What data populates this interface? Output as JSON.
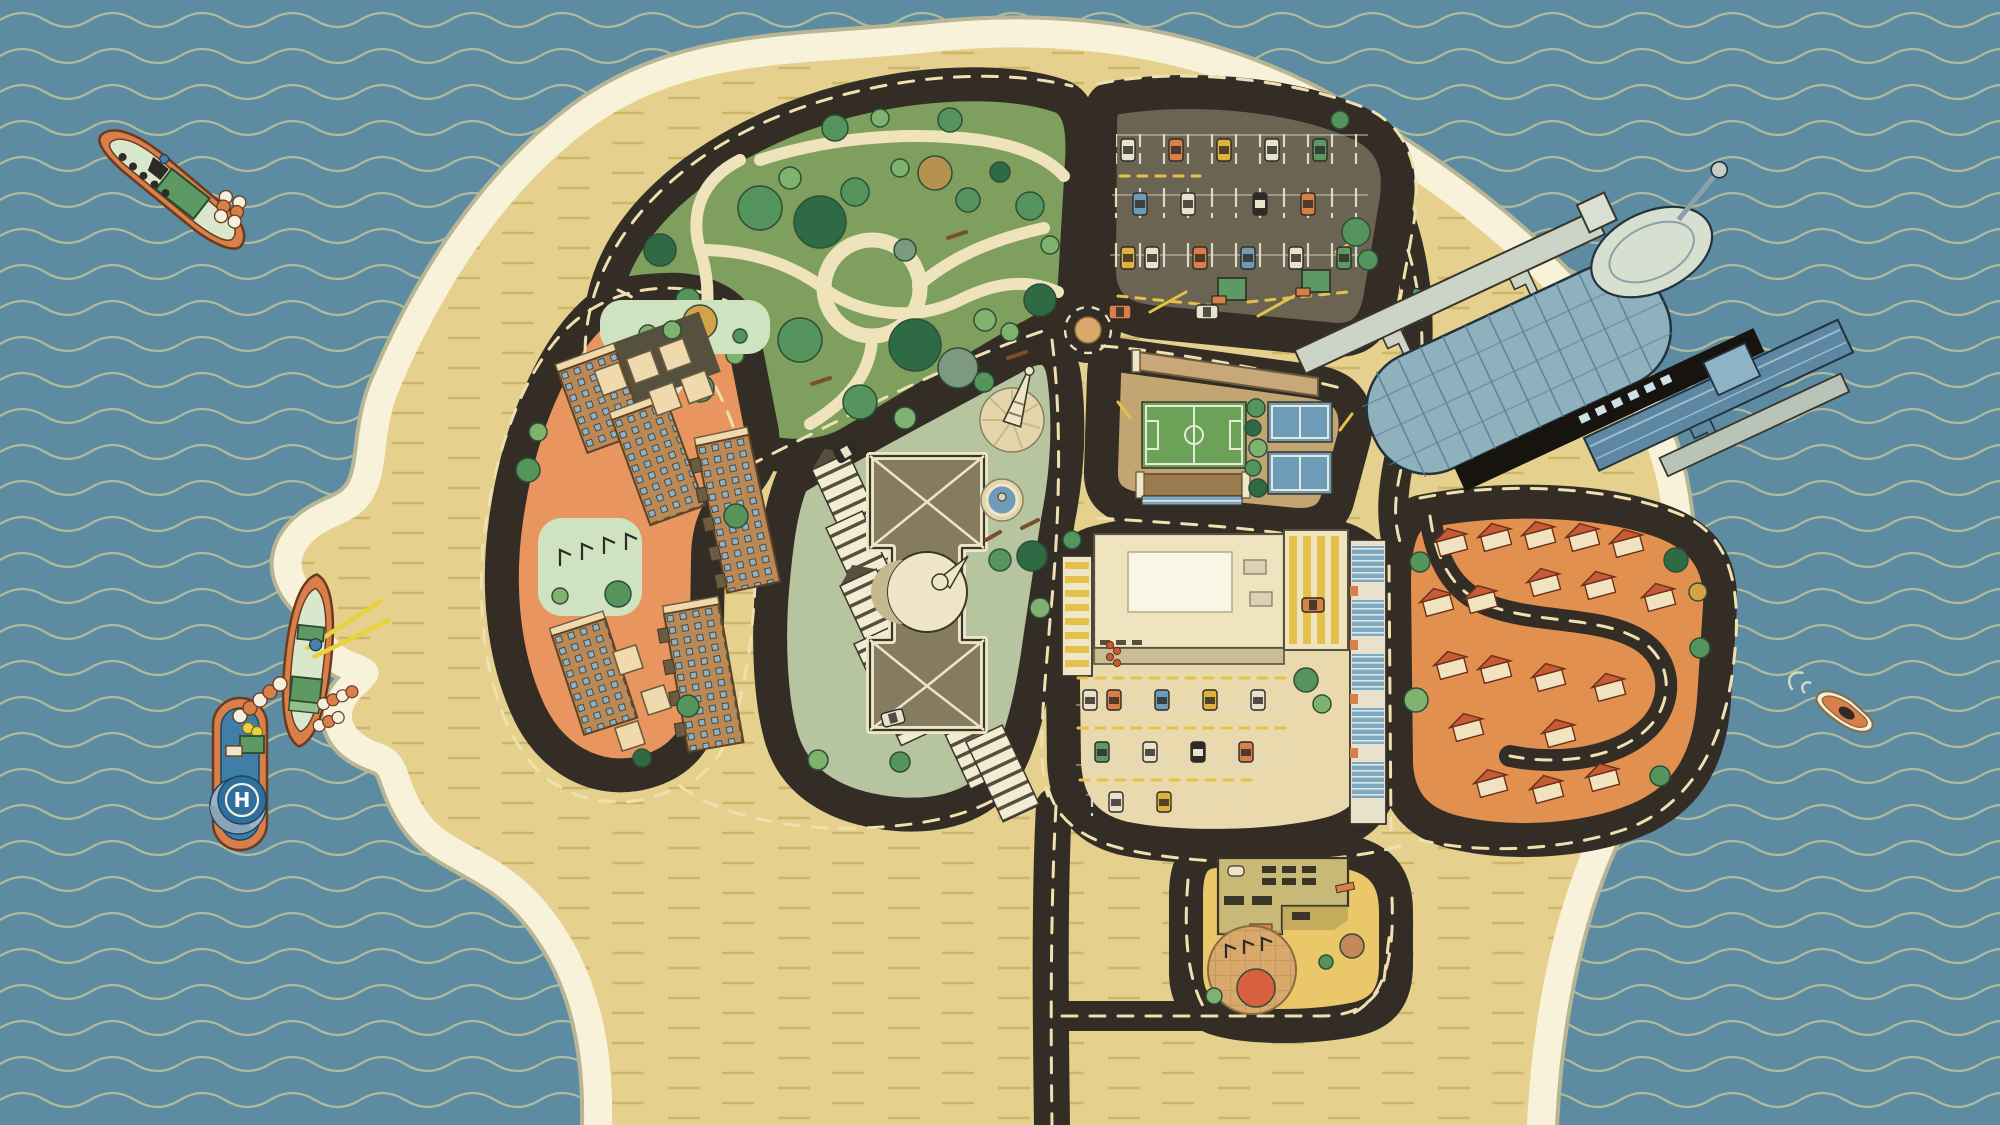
{
  "scene": {
    "description": "Isometric illustration of an island shaped like a human head in profile; the brain is a city map of districts joined by dark ring roads, surrounded by wavy ocean with boats",
    "helipad_letter": "H"
  },
  "palette": {
    "ocean": "#5d8ba1",
    "wave_line": "#aebb9c",
    "shore_rim": "#b8b594",
    "shore_band": "#f8f2da",
    "sand": "#e5d18d",
    "sand_dash": "#cdb56b",
    "road": "#332d26",
    "road_dash": "#efe0b0",
    "lane_dash_yellow": "#e4c14b",
    "parking_line": "#ddd8c4",
    "path_cream": "#efe3bc",
    "pocket_park": "#cfe3c1",
    "roundabout_center": "#d9a96c",
    "fountain_water": "#6f9ab8",
    "dome_cream": "#efe6c8",
    "soccer_green": "#6ba257",
    "tennis_blue": "#6e9cb8",
    "grandstand_brown": "#9b7b4e",
    "sports_hall_tan": "#c8a878",
    "brick": "#b98a58",
    "roof_box_cream": "#efd9ad",
    "slab_white": "#f2ecd4",
    "house_roof": "#c75b36",
    "house_wall": "#f2e3c0",
    "stadium_roof": "#8fb0bd",
    "stadium_rib": "#5f8396",
    "stadium_pod": "#d6dfd0",
    "stadium_beam": "#cbd4c6",
    "stadium_dark": "#17130f",
    "stadium_wing": "#5d87a2",
    "boat_hull_orange": "#d97f4a",
    "boat_deck_mint": "#d9e8cc",
    "boat_cabin_green": "#5d9a63",
    "tug_deck_blue": "#3f7ea6",
    "helipad_blue": "#2e6f9e",
    "rod_yellow": "#e8d23e",
    "tree_dark": "#2e6b45",
    "tree_mid": "#55945d",
    "tree_light": "#7fb26f",
    "tree_pale": "#a3c585",
    "tree_sage": "#7d9a80",
    "tree_tan": "#b5934f",
    "tree_gold": "#d4a247",
    "tree_rust": "#d9603c"
  },
  "districts": [
    {
      "id": "park",
      "name": "City park",
      "color": "#7e9f5e"
    },
    {
      "id": "parking-lot",
      "name": "Parking lot",
      "color": "#6b6452"
    },
    {
      "id": "sports-complex",
      "name": "Sports fields",
      "color": "#c3a571"
    },
    {
      "id": "apartments",
      "name": "Apartment blocks",
      "color": "#e8955f"
    },
    {
      "id": "civic-center",
      "name": "Civic center",
      "color": "#b7c4a0"
    },
    {
      "id": "shopping-mall",
      "name": "Shopping mall",
      "color": "#ead9ad"
    },
    {
      "id": "suburb",
      "name": "Residential suburb",
      "color": "#e2904f"
    },
    {
      "id": "industrial-stem",
      "name": "Industrial brain stem",
      "color": "#eac768"
    }
  ],
  "boats": [
    {
      "id": "cruiser",
      "name": "Cruiser boat"
    },
    {
      "id": "fishing-boat",
      "name": "Fishing boat with yellow rods"
    },
    {
      "id": "helipad-tug",
      "name": "Tug boat with helipad"
    },
    {
      "id": "speedboat",
      "name": "Small speedboat"
    }
  ]
}
